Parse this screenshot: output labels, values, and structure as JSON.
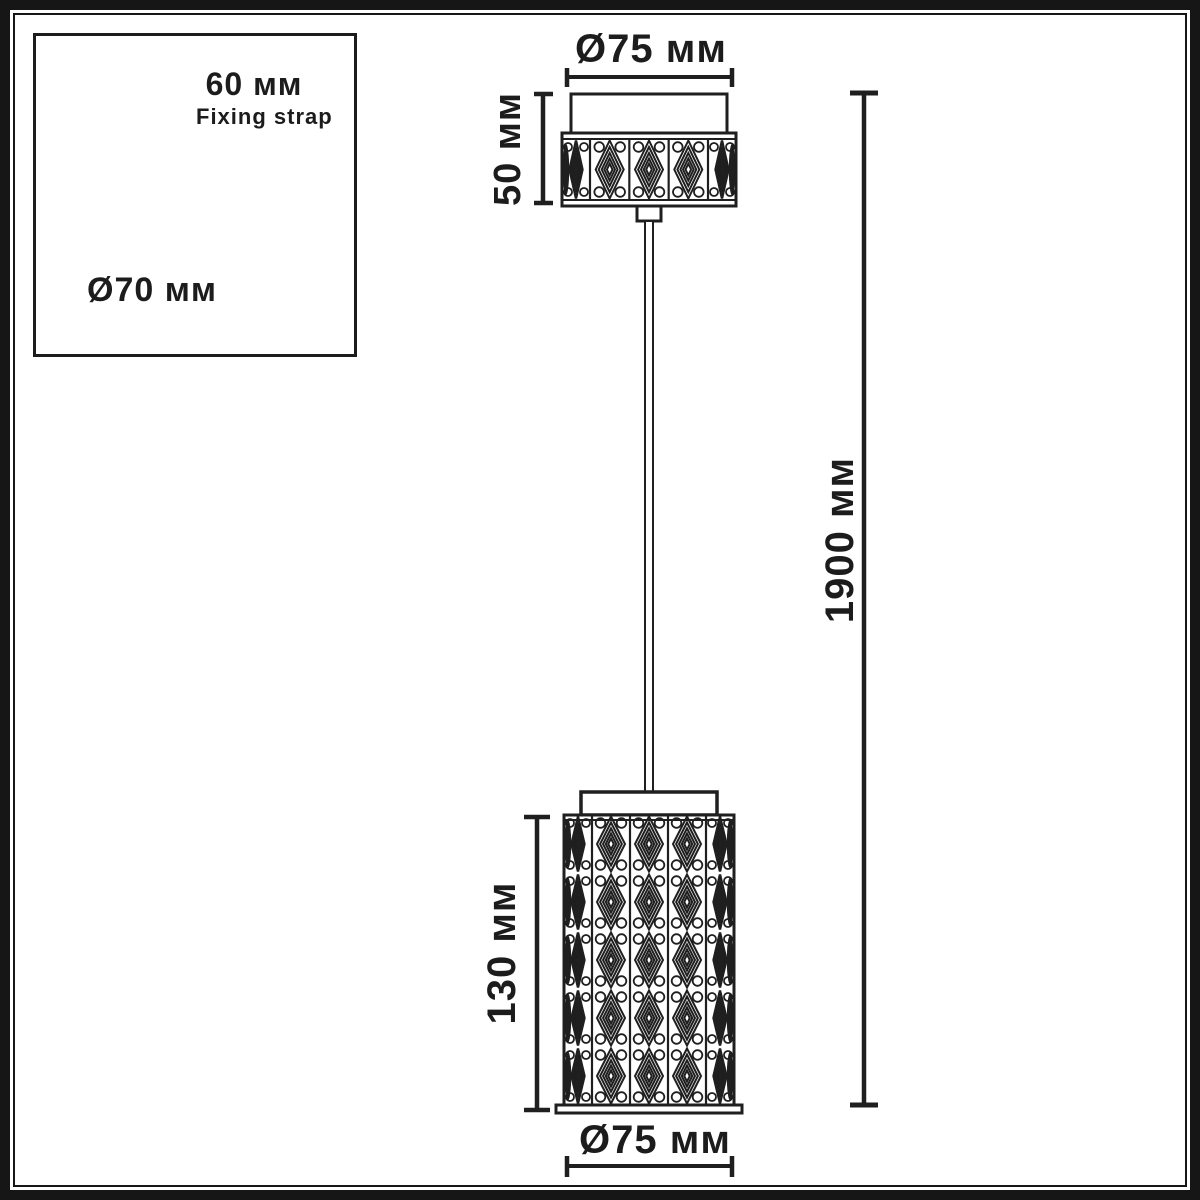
{
  "title": "Pendant lamp dimension drawing",
  "inset": {
    "strap_width_label": "60 мм",
    "strap_name_label": "Fixing strap",
    "base_diameter_label": "Ø70 мм"
  },
  "dimensions": {
    "canopy_diameter_label": "Ø75 мм",
    "canopy_height_label": "50 мм",
    "overall_height_label": "1900 мм",
    "shade_height_label": "130 мм",
    "shade_diameter_label": "Ø75 мм"
  },
  "colors": {
    "line": "#1f1f1f",
    "background": "#ffffff"
  }
}
